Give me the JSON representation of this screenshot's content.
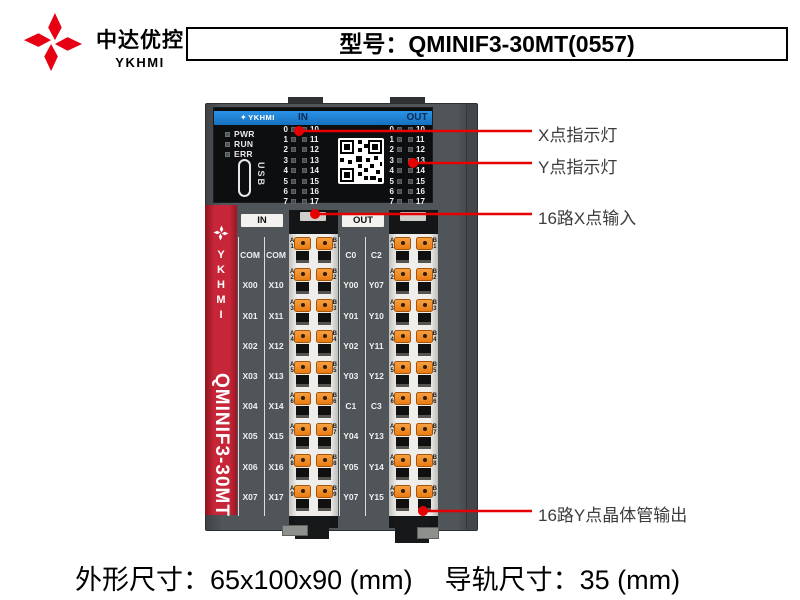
{
  "brand": {
    "name_cn": "中达优控",
    "name_en": "YKHMI"
  },
  "banner": {
    "model_label": "型号：QMINIF3-30MT(0557)"
  },
  "device": {
    "top_panel": {
      "brand": "YKHMI",
      "in_label": "IN",
      "out_label": "OUT",
      "status_leds": [
        "PWR",
        "RUN",
        "ERR"
      ],
      "usb_label": "USB",
      "led_rows": [
        {
          "l": "0",
          "r": "10"
        },
        {
          "l": "1",
          "r": "11"
        },
        {
          "l": "2",
          "r": "12"
        },
        {
          "l": "3",
          "r": "13"
        },
        {
          "l": "4",
          "r": "14"
        },
        {
          "l": "5",
          "r": "15"
        },
        {
          "l": "6",
          "r": "16"
        },
        {
          "l": "7",
          "r": "17"
        }
      ]
    },
    "side_strip": {
      "brand": "YKHMI",
      "model": "QMINIF3-30MT"
    },
    "in_column": {
      "header": "IN",
      "rows": [
        {
          "l": "COM",
          "r": "COM"
        },
        {
          "l": "X00",
          "r": "X10"
        },
        {
          "l": "X01",
          "r": "X11"
        },
        {
          "l": "X02",
          "r": "X12"
        },
        {
          "l": "X03",
          "r": "X13"
        },
        {
          "l": "X04",
          "r": "X14"
        },
        {
          "l": "X05",
          "r": "X15"
        },
        {
          "l": "X06",
          "r": "X16"
        },
        {
          "l": "X07",
          "r": "X17"
        }
      ]
    },
    "out_column": {
      "header": "OUT",
      "rows": [
        {
          "l": "C0",
          "r": "C2"
        },
        {
          "l": "Y00",
          "r": "Y07"
        },
        {
          "l": "Y01",
          "r": "Y10"
        },
        {
          "l": "Y02",
          "r": "Y11"
        },
        {
          "l": "Y03",
          "r": "Y12"
        },
        {
          "l": "C1",
          "r": "C3"
        },
        {
          "l": "Y04",
          "r": "Y13"
        },
        {
          "l": "Y05",
          "r": "Y14"
        },
        {
          "l": "Y07",
          "r": "Y15"
        }
      ]
    },
    "terminal_rows": [
      {
        "a": "A",
        "b": "B",
        "n": "1"
      },
      {
        "a": "A",
        "b": "B",
        "n": "2"
      },
      {
        "a": "A",
        "b": "B",
        "n": "3"
      },
      {
        "a": "A",
        "b": "B",
        "n": "4"
      },
      {
        "a": "A",
        "b": "B",
        "n": "5"
      },
      {
        "a": "A",
        "b": "B",
        "n": "6"
      },
      {
        "a": "A",
        "b": "B",
        "n": "7"
      },
      {
        "a": "A",
        "b": "B",
        "n": "8"
      },
      {
        "a": "A",
        "b": "B",
        "n": "9"
      }
    ]
  },
  "annotations": [
    {
      "label": "X点指示灯"
    },
    {
      "label": "Y点指示灯"
    },
    {
      "label": "16路X点输入"
    },
    {
      "label": "16路Y点晶体管输出"
    }
  ],
  "footer": {
    "dimensions_label": "外形尺寸：65x100x90 (mm)",
    "rail_label": "导轨尺寸：35 (mm)"
  },
  "colors": {
    "brand_red": "#e60012",
    "header_blue": "#1b7fd0",
    "strip_red": "#c62638",
    "clamp_orange": "#ef7f1d",
    "annotation_red": "#e60000",
    "device_gray": "#4b5054",
    "panel_black": "#0c0e10"
  }
}
